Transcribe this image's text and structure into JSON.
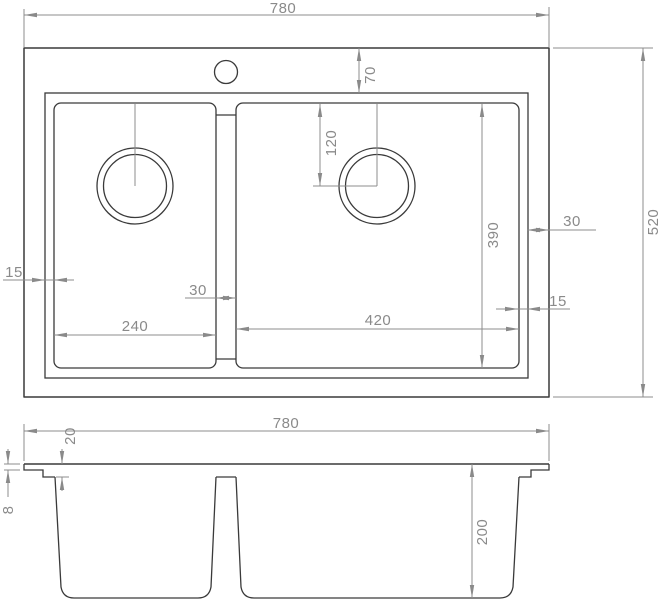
{
  "drawing": {
    "type": "technical-drawing-double-bowl-sink",
    "colors": {
      "background": "#ffffff",
      "outline": "#3a3a3a",
      "dimension_line": "#8c8c8c",
      "dimension_text": "#8a8a8a"
    }
  },
  "dims": {
    "top_overall_width": "780",
    "top_overall_depth": "520",
    "rim_offset_top": "70",
    "drain_offset": "120",
    "right_bowl_depth": "390",
    "rim_to_edge_right": "30",
    "bowl_rim_gap_right": "15",
    "bowl_rim_gap_left": "15",
    "left_bowl_width": "240",
    "divider_width": "30",
    "right_bowl_width": "420",
    "front_overall_width": "780",
    "rim_recess_depth": "20",
    "edge_fold_height": "8",
    "bowl_depth": "200"
  }
}
